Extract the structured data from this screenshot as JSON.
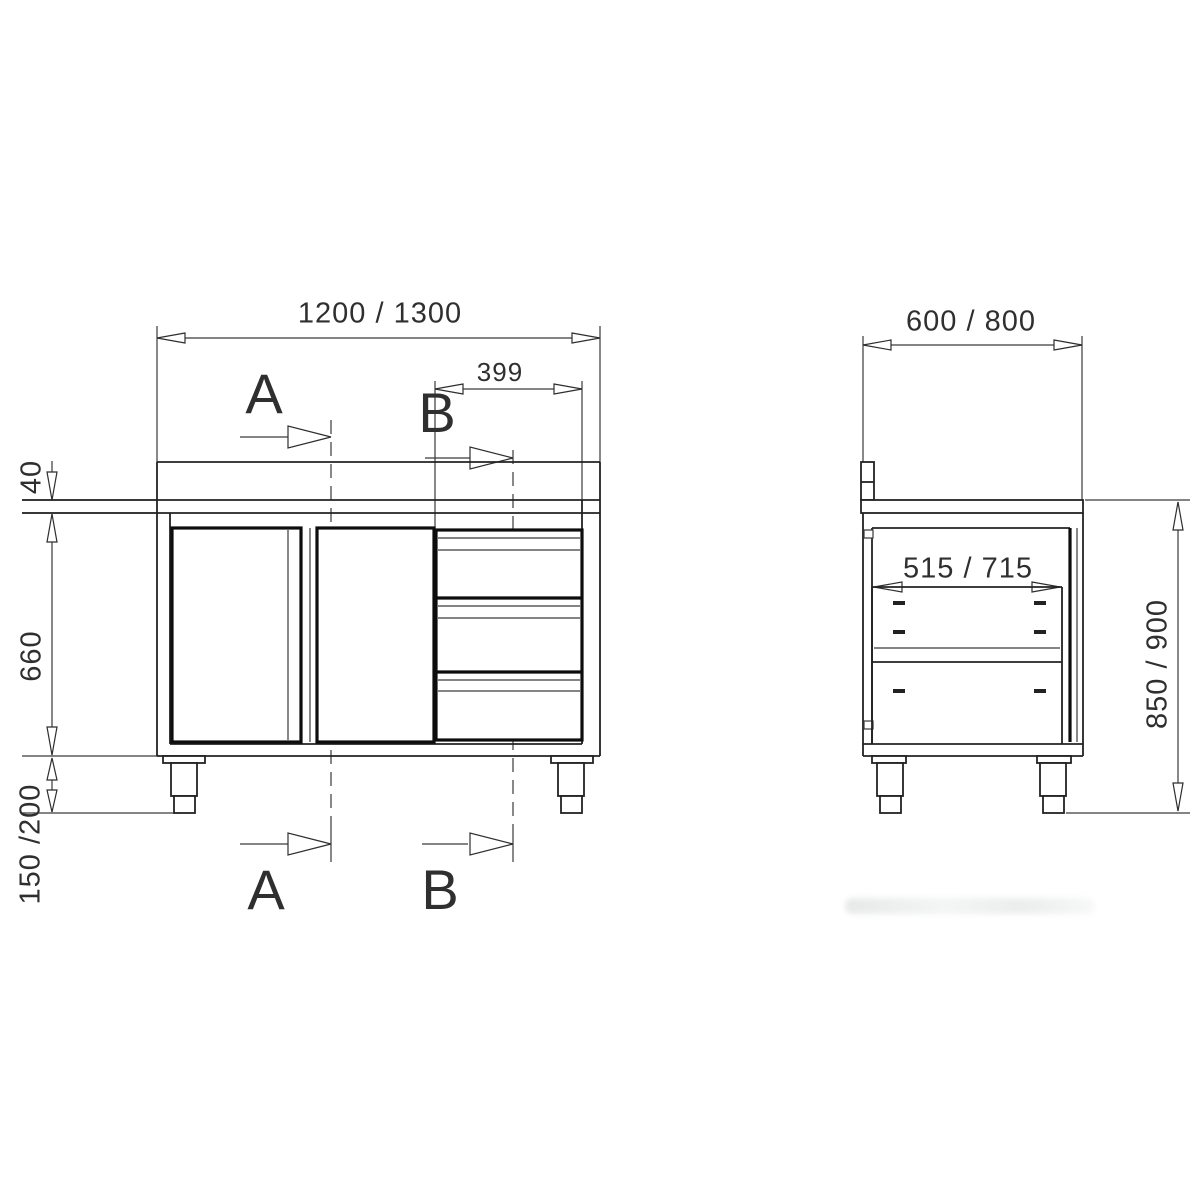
{
  "front_view": {
    "width_dimension": "1200 / 1300",
    "drawer_width_dimension": "399",
    "worktop_thickness_dimension": "40",
    "body_height_dimension": "660",
    "leg_height_dimension": "150 /200",
    "section_marker_a": "A",
    "section_marker_b": "B"
  },
  "side_view": {
    "depth_dimension": "600 / 800",
    "inner_depth_dimension": "515 / 715",
    "overall_height_dimension": "850 / 900"
  },
  "colors": {
    "background": "#ffffff",
    "dimension_line": "#3a3a3a",
    "object_line": "#222222",
    "panel_line": "#0d0d0d"
  }
}
